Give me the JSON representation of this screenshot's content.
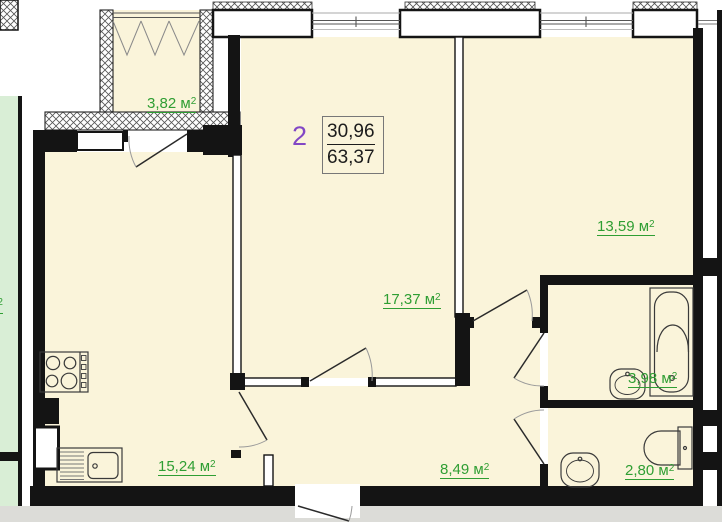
{
  "plan": {
    "apartment_number": "2",
    "summary": {
      "living_area": "30,96",
      "total_area": "63,37"
    },
    "unit": "м",
    "unit_sup": "2",
    "areas": {
      "balcony": "3,82",
      "kitchen": "15,24",
      "living_room": "17,37",
      "bedroom": "13,59",
      "hallway": "8,49",
      "bathroom": "3,98",
      "wc": "2,80"
    },
    "colors": {
      "room_fill": "#faf4da",
      "wall": "#141414",
      "label_green": "#2f9e33",
      "number_purple": "#8247c5",
      "outside_gray": "#dcdcd8",
      "neighbor_green": "#d9eed6",
      "value_text": "#1c1c1c"
    }
  }
}
